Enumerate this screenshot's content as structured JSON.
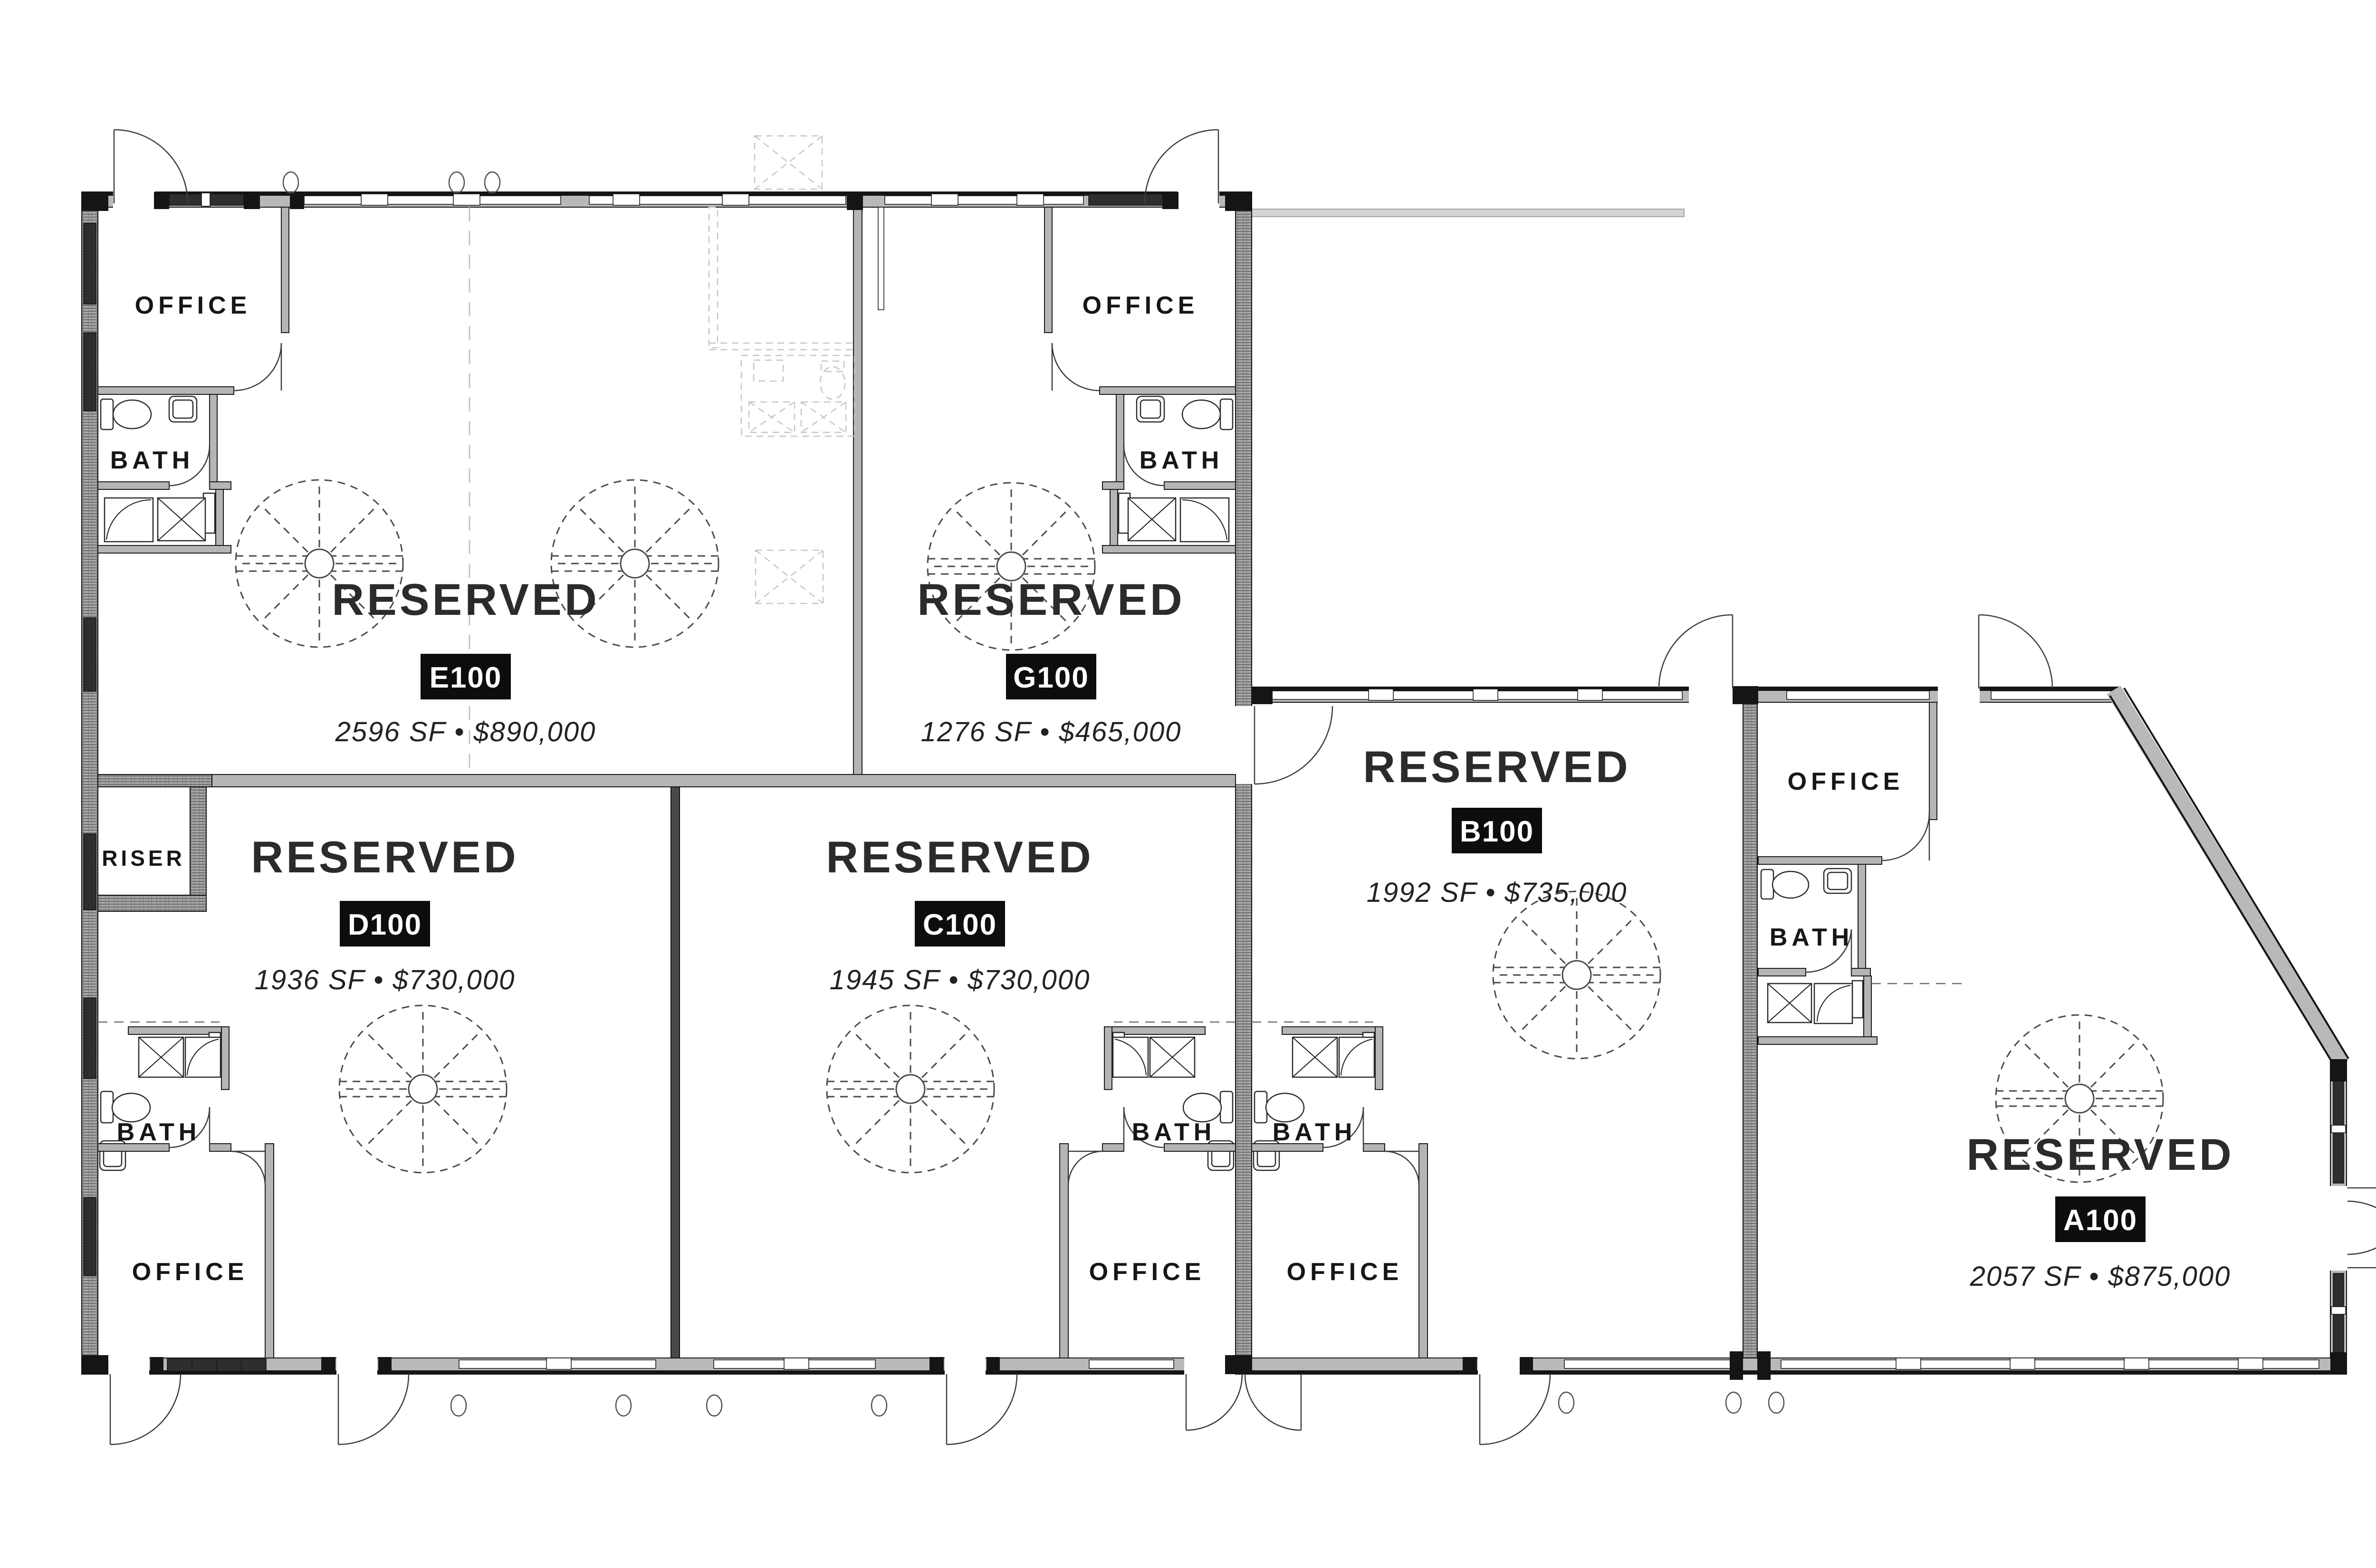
{
  "labels": {
    "reserved": "RESERVED",
    "office": "OFFICE",
    "bath": "BATH",
    "riser": "RISER"
  },
  "units": [
    {
      "id": "E100",
      "status": "RESERVED",
      "size_price": "2596 SF • $890,000"
    },
    {
      "id": "G100",
      "status": "RESERVED",
      "size_price": "1276 SF • $465,000"
    },
    {
      "id": "D100",
      "status": "RESERVED",
      "size_price": "1936 SF • $730,000"
    },
    {
      "id": "C100",
      "status": "RESERVED",
      "size_price": "1945 SF • $730,000"
    },
    {
      "id": "B100",
      "status": "RESERVED",
      "size_price": "1992 SF • $735,000"
    },
    {
      "id": "A100",
      "status": "RESERVED",
      "size_price": "2057 SF • $875,000"
    }
  ],
  "colors": {
    "badge_bg": "#0d0d0d",
    "badge_text": "#ffffff",
    "label_text": "#262626",
    "wall_dark": "#2e2e2e",
    "wall_light": "#b9b9b9",
    "background": "#ffffff"
  }
}
